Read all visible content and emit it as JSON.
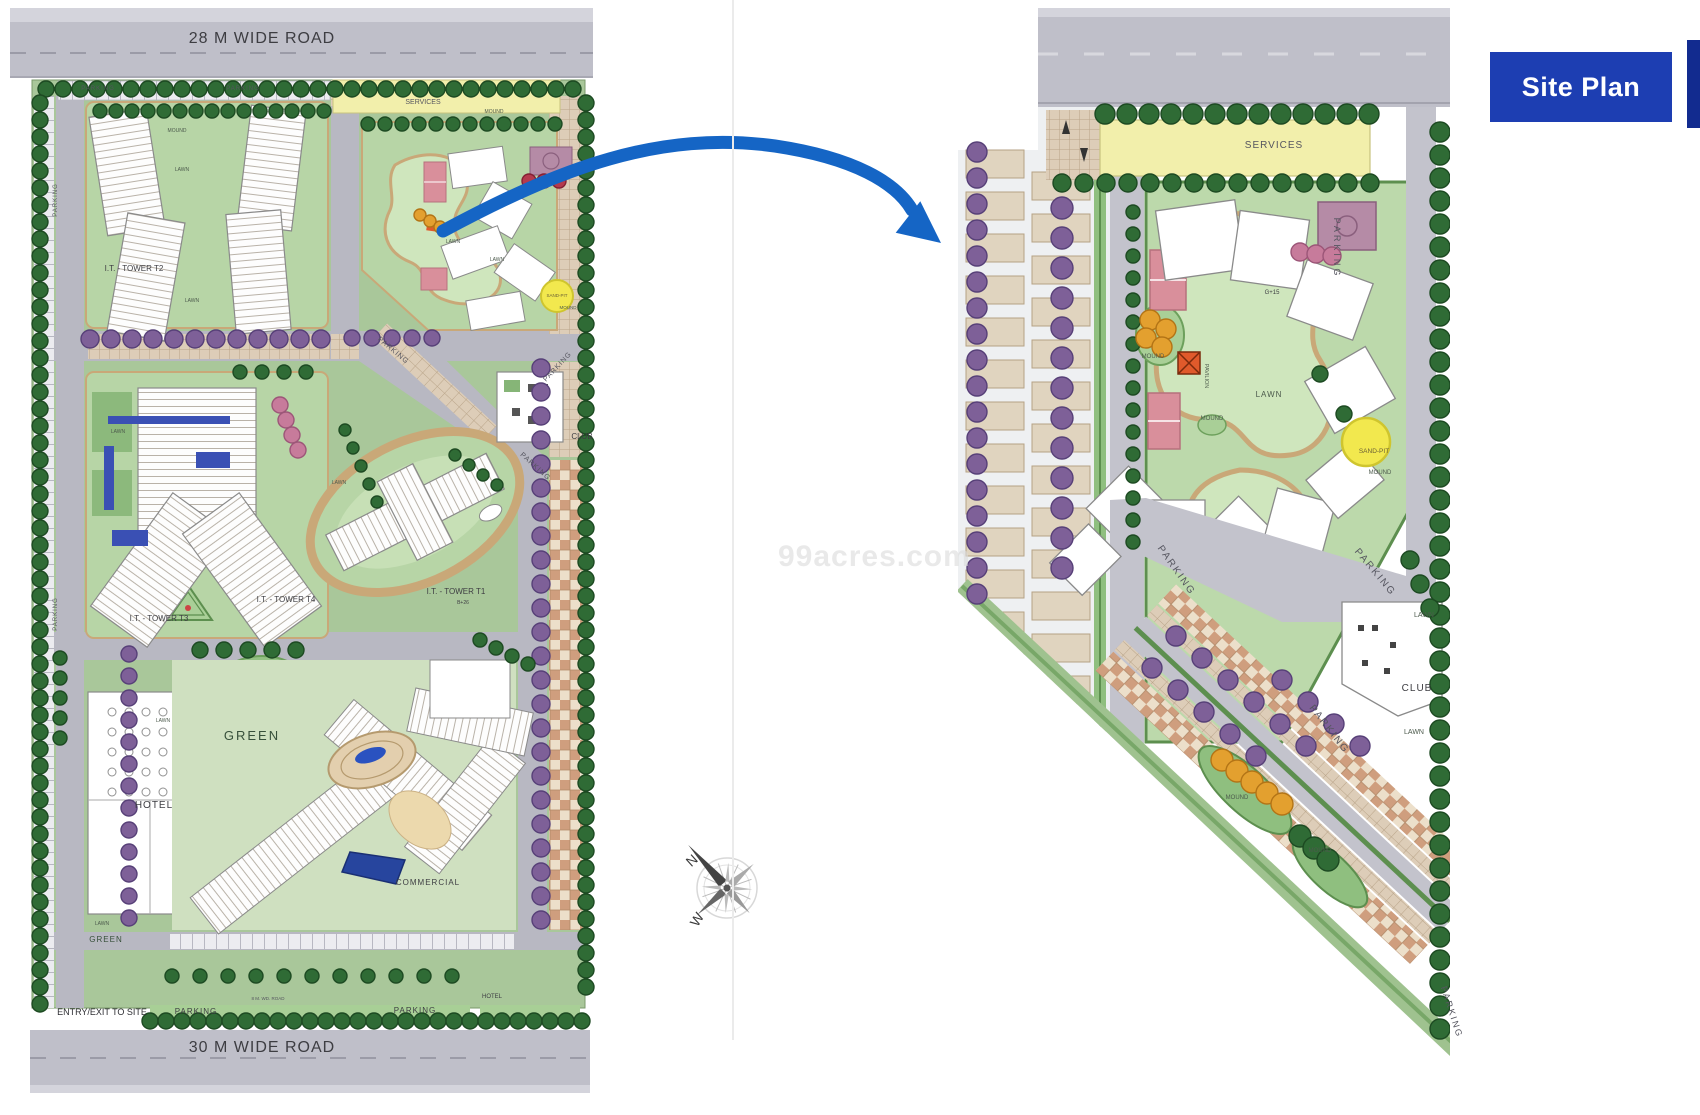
{
  "badge": {
    "label": "Site Plan"
  },
  "watermark": {
    "text": "99acres.com"
  },
  "colors": {
    "badge_blue": "#1d3eb2",
    "badge_edge": "#122b8f",
    "arrow_blue": "#1565c5",
    "services_yellow": "#f2efab",
    "road_gray": "#bfbfc9",
    "lawn_green": "#aecb9e",
    "tree_dark_green": "#2f6b35",
    "tree_purple": "#7e6098",
    "sand_pit_yellow": "#f2e84e"
  },
  "left_plan": {
    "labels": [
      {
        "t": "28 M WIDE ROAD",
        "x": 262,
        "y": 43,
        "s": 16,
        "ls": 1,
        "c": "#3d3d42"
      },
      {
        "t": "30 M WIDE ROAD",
        "x": 262,
        "y": 1052,
        "s": 16,
        "ls": 1,
        "c": "#3d3d42"
      },
      {
        "t": "PARKING",
        "x": 98,
        "y": 90,
        "s": 6,
        "ls": 1,
        "c": "#55555f"
      },
      {
        "t": "PARKING",
        "x": 243,
        "y": 90,
        "s": 6,
        "ls": 1,
        "c": "#55555f"
      },
      {
        "t": "SERVICES",
        "x": 423,
        "y": 104,
        "s": 7,
        "c": "#55555f"
      },
      {
        "t": "PARKING",
        "x": 57,
        "y": 200,
        "s": 6,
        "r": -90,
        "ls": 1,
        "c": "#55555f"
      },
      {
        "t": "PARKING",
        "x": 57,
        "y": 614,
        "s": 6,
        "r": -90,
        "ls": 1,
        "c": "#55555f"
      },
      {
        "t": "MOUND",
        "x": 177,
        "y": 132,
        "s": 5,
        "c": "#4c5a4c"
      },
      {
        "t": "MOUND",
        "x": 494,
        "y": 113,
        "s": 5,
        "c": "#4c5a4c"
      },
      {
        "t": "LAWN",
        "x": 182,
        "y": 171,
        "s": 5,
        "c": "#4c5a4c"
      },
      {
        "t": "LAWN",
        "x": 192,
        "y": 302,
        "s": 5,
        "c": "#4c5a4c"
      },
      {
        "t": "LAWN",
        "x": 453,
        "y": 243,
        "s": 5,
        "c": "#4c5a4c"
      },
      {
        "t": "LAWN",
        "x": 497,
        "y": 261,
        "s": 5,
        "c": "#4c5a4c"
      },
      {
        "t": "MOUND",
        "x": 568,
        "y": 309,
        "s": 4.5,
        "c": "#4c5a4c"
      },
      {
        "t": "SAND-PIT",
        "x": 557,
        "y": 297,
        "s": 4.5,
        "c": "#6b6035"
      },
      {
        "t": "I.T. - TOWER T2",
        "x": 134,
        "y": 271,
        "s": 8,
        "c": "#3d3d42"
      },
      {
        "t": "PARKING",
        "x": 392,
        "y": 352,
        "s": 7,
        "r": 40,
        "ls": 1,
        "c": "#55555f"
      },
      {
        "t": "PARKING",
        "x": 559,
        "y": 368,
        "s": 7,
        "r": -47,
        "ls": 1,
        "c": "#55555f"
      },
      {
        "t": "CLUB",
        "x": 582,
        "y": 439,
        "s": 8,
        "c": "#3d3d42"
      },
      {
        "t": "LAWN",
        "x": 118,
        "y": 433,
        "s": 5,
        "c": "#4c5a4c"
      },
      {
        "t": "LAWN",
        "x": 339,
        "y": 484,
        "s": 5,
        "c": "#4c5a4c"
      },
      {
        "t": "PARKING",
        "x": 534,
        "y": 468,
        "s": 7,
        "r": 42,
        "ls": 1,
        "c": "#55555f"
      },
      {
        "t": "I.T. - TOWER T1",
        "x": 456,
        "y": 594,
        "s": 8,
        "c": "#3d3d42"
      },
      {
        "t": "B+26",
        "x": 463,
        "y": 604,
        "s": 5,
        "c": "#3d3d42"
      },
      {
        "t": "I.T. - TOWER T4",
        "x": 286,
        "y": 602,
        "s": 8,
        "c": "#3d3d42"
      },
      {
        "t": "I.T. - TOWER T3",
        "x": 159,
        "y": 621,
        "s": 8,
        "c": "#3d3d42"
      },
      {
        "t": "GREEN",
        "x": 252,
        "y": 740,
        "s": 13,
        "ls": 2,
        "c": "#37503a"
      },
      {
        "t": "LAWN",
        "x": 163,
        "y": 722,
        "s": 5,
        "c": "#4c5a4c"
      },
      {
        "t": "HOTEL",
        "x": 154,
        "y": 808,
        "s": 10,
        "ls": 1,
        "c": "#3d3d42"
      },
      {
        "t": "COMMERCIAL",
        "x": 428,
        "y": 885,
        "s": 8,
        "ls": 1,
        "c": "#3d3d42"
      },
      {
        "t": "LAWN",
        "x": 102,
        "y": 925,
        "s": 5,
        "c": "#4c5a4c"
      },
      {
        "t": "GREEN",
        "x": 106,
        "y": 942,
        "s": 8,
        "ls": 1,
        "c": "#37503a"
      },
      {
        "t": "8 M. WD. ROAD",
        "x": 268,
        "y": 1000,
        "s": 4.5,
        "c": "#55555f"
      },
      {
        "t": "ENTRY/EXIT TO SITE",
        "x": 102,
        "y": 1015,
        "s": 9,
        "c": "#2e2e33"
      },
      {
        "t": "PARKING",
        "x": 196,
        "y": 1014,
        "s": 8,
        "ls": 1,
        "c": "#3d3d42"
      },
      {
        "t": "PARKING",
        "x": 415,
        "y": 1013,
        "s": 8,
        "ls": 1,
        "c": "#3d3d42"
      },
      {
        "t": "HOTEL",
        "x": 492,
        "y": 998,
        "s": 6,
        "c": "#3d3d42"
      }
    ]
  },
  "right_plan": {
    "labels": [
      {
        "t": "SERVICES",
        "x": 1274,
        "y": 148,
        "s": 10,
        "ls": 1,
        "c": "#55555f"
      },
      {
        "t": "PARKING",
        "x": 1334,
        "y": 248,
        "s": 9,
        "r": 90,
        "ls": 3,
        "c": "#55555f"
      },
      {
        "t": "G+15",
        "x": 1272,
        "y": 294,
        "s": 6,
        "c": "#3d3d42"
      },
      {
        "t": "MOUND",
        "x": 1153,
        "y": 358,
        "s": 6,
        "c": "#4c5a4c"
      },
      {
        "t": "PAVILION",
        "x": 1205,
        "y": 376,
        "s": 5.5,
        "r": 90,
        "c": "#4c5a4c"
      },
      {
        "t": "LAWN",
        "x": 1269,
        "y": 397,
        "s": 8,
        "ls": 1,
        "c": "#4c5a4c"
      },
      {
        "t": "MOUND",
        "x": 1212,
        "y": 420,
        "s": 6,
        "c": "#4c5a4c"
      },
      {
        "t": "SAND-PIT",
        "x": 1374,
        "y": 453,
        "s": 6.5,
        "c": "#6b6035"
      },
      {
        "t": "MOUND",
        "x": 1380,
        "y": 474,
        "s": 6,
        "c": "#4c5a4c"
      },
      {
        "t": "PARKING",
        "x": 1174,
        "y": 572,
        "s": 10,
        "r": 55,
        "ls": 2,
        "c": "#55555f"
      },
      {
        "t": "PARKING",
        "x": 1373,
        "y": 574,
        "s": 10,
        "r": 50,
        "ls": 2,
        "c": "#55555f"
      },
      {
        "t": "LAWN",
        "x": 1424,
        "y": 617,
        "s": 7,
        "c": "#4c5a4c"
      },
      {
        "t": "CLUB",
        "x": 1417,
        "y": 691,
        "s": 10,
        "ls": 1,
        "c": "#3d3d42"
      },
      {
        "t": "PARKING",
        "x": 1327,
        "y": 731,
        "s": 10,
        "r": 52,
        "ls": 2,
        "c": "#55555f"
      },
      {
        "t": "LAWN",
        "x": 1414,
        "y": 734,
        "s": 7,
        "c": "#4c5a4c"
      },
      {
        "t": "MOUND",
        "x": 1237,
        "y": 799,
        "s": 6,
        "c": "#4c5a4c"
      },
      {
        "t": "MOUND",
        "x": 1320,
        "y": 852,
        "s": 6,
        "c": "#4c5a4c"
      },
      {
        "t": "PARKING",
        "x": 1449,
        "y": 1013,
        "s": 9,
        "r": 72,
        "ls": 2,
        "c": "#55555f"
      }
    ]
  },
  "compass": {
    "labels": [
      {
        "t": "N",
        "x": 695,
        "y": 864,
        "s": 14,
        "r": -42,
        "c": "#3a3a3a"
      },
      {
        "t": "W",
        "x": 701,
        "y": 922,
        "s": 14,
        "r": -58,
        "c": "#3a3a3a"
      }
    ]
  }
}
